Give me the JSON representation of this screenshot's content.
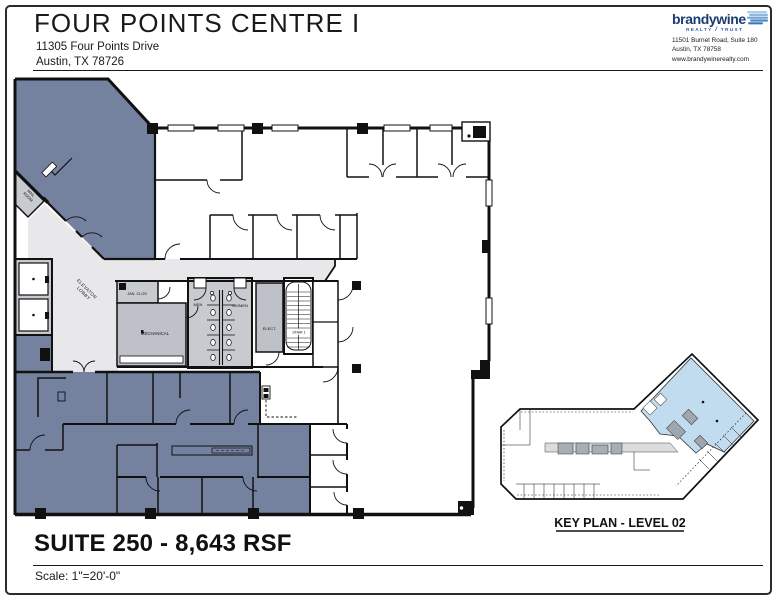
{
  "header": {
    "building_name": "FOUR POINTS CENTRE I",
    "address_line1": "11305 Four Points Drive",
    "address_line2": "Austin, TX 78726"
  },
  "brand": {
    "logo_text": "brandywine",
    "tagline_word1": "REALTY",
    "tagline_word2": "TRUST",
    "address_line1": "11501 Burnet Road, Suite 180",
    "address_line2": "Austin, TX 78758",
    "website": "www.brandywinerealty.com"
  },
  "floor_plan": {
    "labels": {
      "mail_room_line1": "MAIL",
      "mail_room_line2": "ROOM",
      "elevator_lobby_line1": "ELEVATOR",
      "elevator_lobby_line2": "LOBBY",
      "jan_clos": "JAN. CLOS",
      "mechanical": "MECHANICAL",
      "men": "MEN",
      "women": "WOMEN",
      "elect": "ELECT.",
      "stair": "STAIR 1"
    },
    "colors": {
      "suite_fill": "#74829F",
      "core_fill": "#C7CACF",
      "mech_fill": "#BEC2C8",
      "lobby_fill": "#E8E8EA",
      "wall": "#111111",
      "keyplan_highlight": "#C2DCEF"
    }
  },
  "key_plan": {
    "caption": "KEY PLAN - LEVEL 02"
  },
  "footer": {
    "suite_title": "SUITE 250 - 8,643 RSF",
    "scale_text": "Scale:  1\"=20'-0\""
  }
}
